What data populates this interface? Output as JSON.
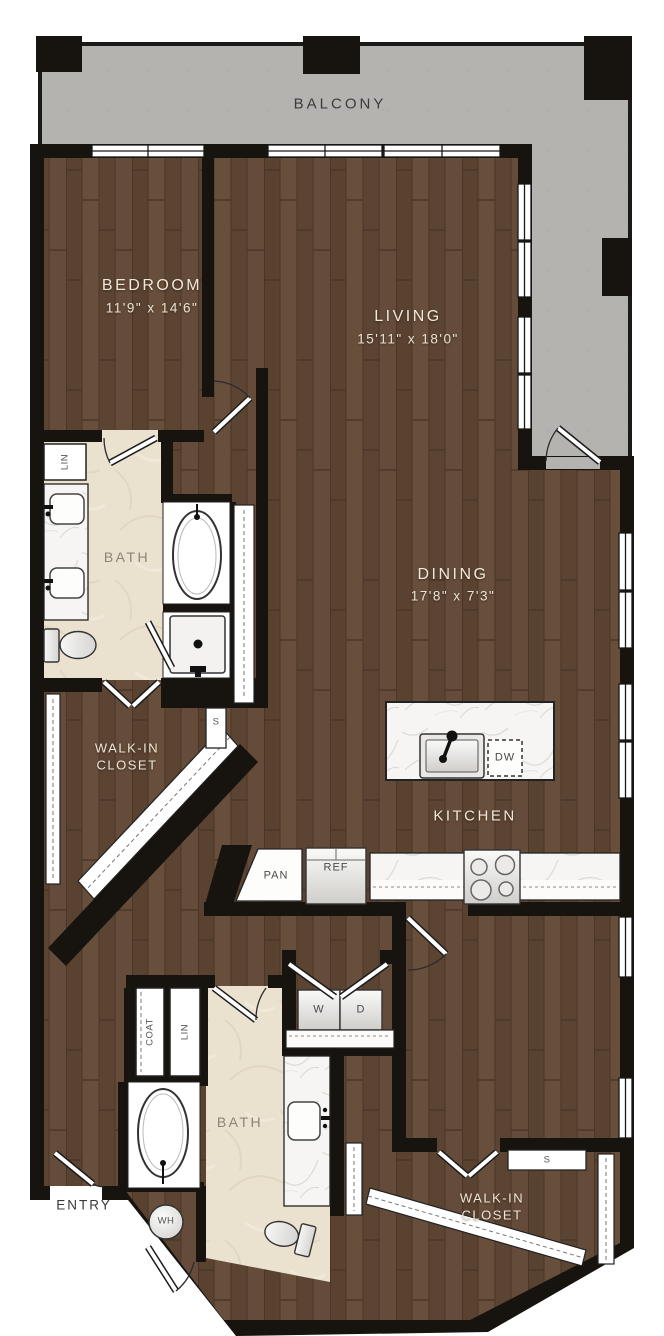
{
  "rooms": {
    "balcony": {
      "label": "BALCONY"
    },
    "bedroom1": {
      "label": "BEDROOM",
      "dims": "11'9\" x 14'6\""
    },
    "living": {
      "label": "LIVING",
      "dims": "15'11\" x 18'0\""
    },
    "dining": {
      "label": "DINING",
      "dims": "17'8\" x 7'3\""
    },
    "kitchen": {
      "label": "KITCHEN"
    },
    "bath1": {
      "label": "BATH"
    },
    "bath2": {
      "label": "BATH"
    },
    "walkin1": {
      "line1": "WALK-IN",
      "line2": "CLOSET"
    },
    "walkin2": {
      "line1": "WALK-IN",
      "line2": "CLOSET"
    },
    "entry": {
      "label": "ENTRY"
    }
  },
  "closets": {
    "linen1": "LIN",
    "linen2": "LIN",
    "coat": "COAT",
    "shelf1": "S",
    "shelf2": "S"
  },
  "appliances": {
    "pantry": "PAN",
    "refrigerator": "REF",
    "dishwasher": "DW",
    "washer": "W",
    "dryer": "D",
    "water_heater": "WH"
  },
  "colors": {
    "wall": "#17130f",
    "wood": "#5f4735",
    "tile": "#eae1cf",
    "balcony": "#b5b3b0",
    "marble": "#f6f5f3",
    "label_light": "#f1e8d8",
    "label_dark": "#3c3c3c"
  }
}
